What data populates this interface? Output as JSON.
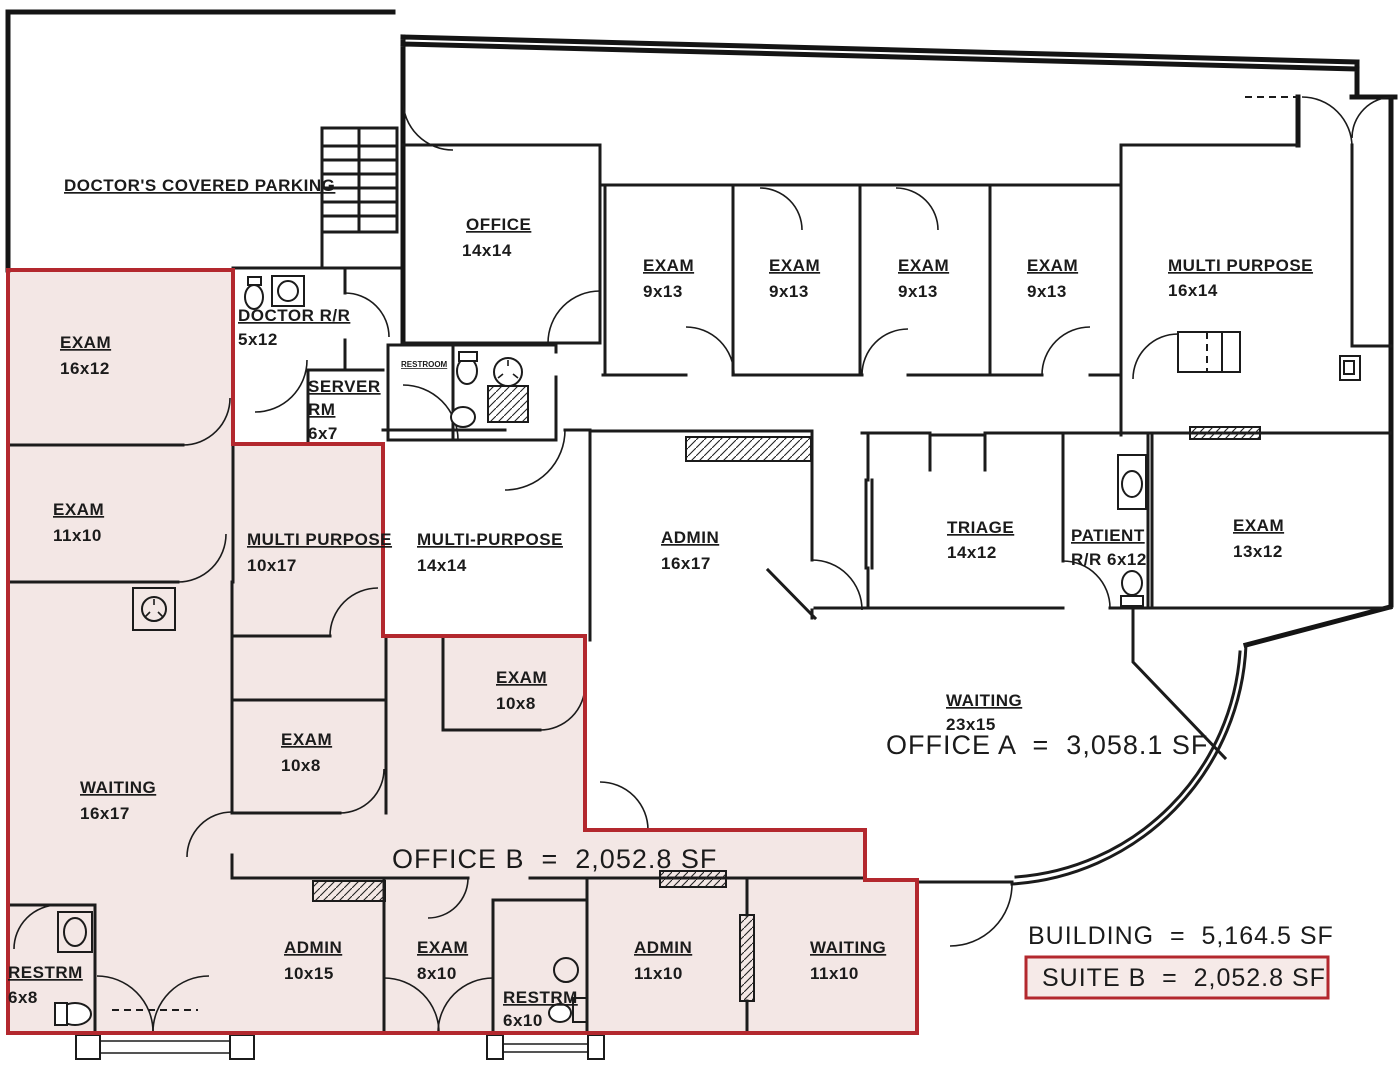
{
  "colors": {
    "suite_fill": "#f3e7e5",
    "suite_outline": "#b3282e",
    "wall": "#1b1b1b",
    "suite_box_fill": "#f6eae8"
  },
  "parking": {
    "label": "DOCTOR'S COVERED PARKING"
  },
  "rooms": [
    {
      "id": "office-14x14",
      "name": "OFFICE",
      "size": "14x14"
    },
    {
      "id": "exam-9x13-a",
      "name": "EXAM",
      "size": "9x13"
    },
    {
      "id": "exam-9x13-b",
      "name": "EXAM",
      "size": "9x13"
    },
    {
      "id": "exam-9x13-c",
      "name": "EXAM",
      "size": "9x13"
    },
    {
      "id": "exam-9x13-d",
      "name": "EXAM",
      "size": "9x13"
    },
    {
      "id": "multi-purpose-16x14",
      "name": "MULTI PURPOSE",
      "size": "16x14"
    },
    {
      "id": "doctor-rr",
      "name": "DOCTOR R/R",
      "size": "5x12"
    },
    {
      "id": "server-rm",
      "name": "SERVER",
      "name2": "RM",
      "size": "6x7"
    },
    {
      "id": "exam-16x12",
      "name": "EXAM",
      "size": "16x12"
    },
    {
      "id": "exam-11x10",
      "name": "EXAM",
      "size": "11x10"
    },
    {
      "id": "multi-purpose-10x17",
      "name": "MULTI PURPOSE",
      "size": "10x17"
    },
    {
      "id": "multi-purpose-14x14",
      "name": "MULTI-PURPOSE",
      "size": "14x14"
    },
    {
      "id": "admin-16x17",
      "name": "ADMIN",
      "size": "16x17"
    },
    {
      "id": "triage",
      "name": "TRIAGE",
      "size": "14x12"
    },
    {
      "id": "patient-rr",
      "name": "PATIENT",
      "size": "R/R 6x12"
    },
    {
      "id": "exam-13x12",
      "name": "EXAM",
      "size": "13x12"
    },
    {
      "id": "waiting-23x15",
      "name": "WAITING",
      "size": "23x15"
    },
    {
      "id": "exam-10x8-a",
      "name": "EXAM",
      "size": "10x8"
    },
    {
      "id": "waiting-16x17",
      "name": "WAITING",
      "size": "16x17"
    },
    {
      "id": "exam-10x8-b",
      "name": "EXAM",
      "size": "10x8"
    },
    {
      "id": "restrm-6x8",
      "name": "RESTRM",
      "size": "6x8"
    },
    {
      "id": "admin-10x15",
      "name": "ADMIN",
      "size": "10x15"
    },
    {
      "id": "exam-8x10",
      "name": "EXAM",
      "size": "8x10"
    },
    {
      "id": "restrm-6x10",
      "name": "RESTRM",
      "size": "6x10"
    },
    {
      "id": "admin-11x10",
      "name": "ADMIN",
      "size": "11x10"
    },
    {
      "id": "waiting-11x10",
      "name": "WAITING",
      "size": "11x10"
    }
  ],
  "small_labels": {
    "restroom": "RESTROOM"
  },
  "areas": {
    "office_a": "OFFICE A  =  3,058.1 SF",
    "office_b": "OFFICE B  =  2,052.8 SF",
    "building": "BUILDING  =  5,164.5 SF",
    "suite_b": "SUITE B  =  2,052.8 SF"
  }
}
